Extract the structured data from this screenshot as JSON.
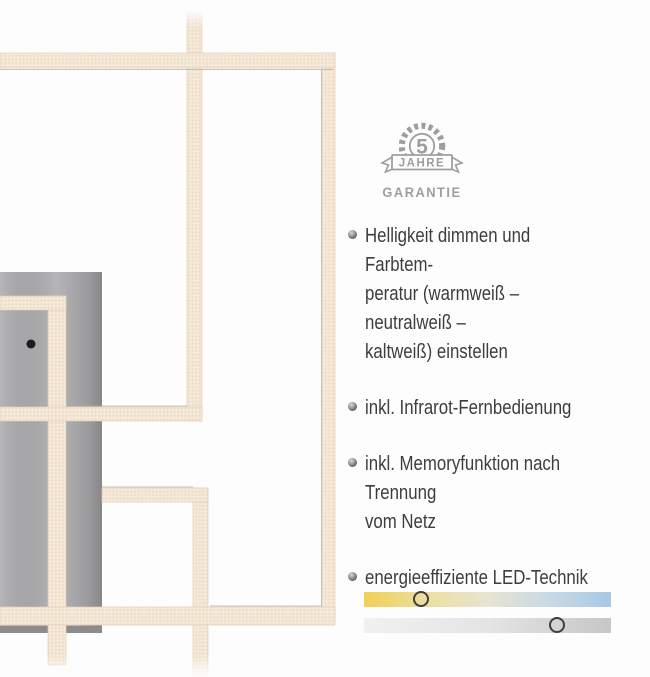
{
  "page": {
    "background": "#fdfdfd"
  },
  "warranty_badge": {
    "number": "5",
    "banner": "JAHRE",
    "label": "GARANTIE",
    "color": "#9e9e9e"
  },
  "features": {
    "items": [
      "Helligkeit dimmen und Farbtem-\nperatur (warmweiß – neutralweiß –\nkaltweiß) einstellen",
      "inkl. Infrarot-Fernbedienung",
      "inkl. Memoryfunktion nach Trennung\nvom Netz",
      "energieeffiziente LED-Technik"
    ]
  },
  "sliders": {
    "color_temperature": {
      "name": "color-temperature",
      "value_percent": 23,
      "gradient": [
        "#f0d055",
        "#ecdf9f",
        "#e7e4d2",
        "#c9d9e5",
        "#a7c9e3"
      ]
    },
    "brightness": {
      "name": "brightness",
      "value_percent": 78,
      "gradient": [
        "#f1f1f1",
        "#e4e4e4",
        "#c7c7c7"
      ]
    }
  },
  "lamp": {
    "bar_color": "#f5e9d9",
    "bar_dot_color": "#ecd9c1",
    "bar_edge_color": "#e2cfb6",
    "plate_color": "#adadaf",
    "shadow_line_color": "#b2b2b2",
    "sensor_color": "#1c1c1c"
  }
}
